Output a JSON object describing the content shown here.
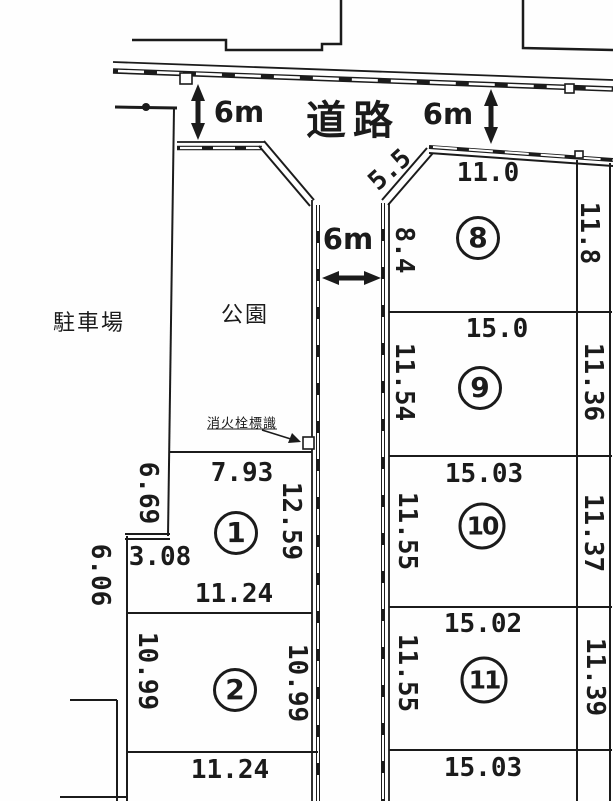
{
  "document": {
    "type": "land-plot-layout-map"
  },
  "colors": {
    "ink": "#1b1b1b",
    "paper": "#fefefe"
  },
  "road": {
    "label": "道路",
    "width_top_left": "6m",
    "width_top_right": "6m",
    "width_center": "6m"
  },
  "areas": {
    "parking_label": "駐車場",
    "park_label": "公園"
  },
  "annotations": {
    "fire_hydrant_sign_label": "消火栓標識"
  },
  "plots": [
    {
      "number": "1",
      "dims": {
        "top": "7.93",
        "bottom": "11.24",
        "right": "12.59",
        "left_upper": "6.69",
        "left_step": "3.08",
        "left_lower": "6.06"
      }
    },
    {
      "number": "2",
      "dims": {
        "left": "10.99",
        "right": "10.99",
        "bottom": "11.24"
      }
    },
    {
      "number": "8",
      "dims": {
        "top": "11.0",
        "left": "8.4",
        "right": "11.8",
        "diagonal": "5.5"
      }
    },
    {
      "number": "9",
      "dims": {
        "top": "15.0",
        "left": "11.54",
        "right": "11.36"
      }
    },
    {
      "number": "10",
      "dims": {
        "top": "15.03",
        "left": "11.55",
        "right": "11.37"
      }
    },
    {
      "number": "11",
      "dims": {
        "top": "15.02",
        "left": "11.55",
        "right": "11.39",
        "bottom": "15.03"
      }
    }
  ]
}
